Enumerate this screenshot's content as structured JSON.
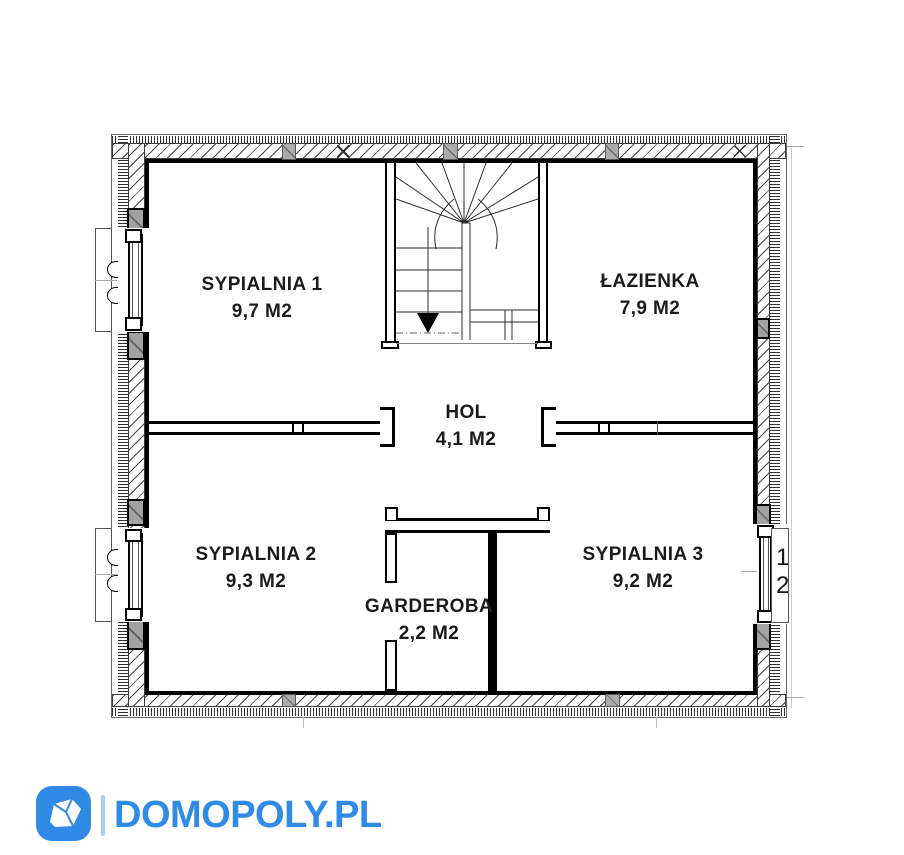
{
  "brand": {
    "name": "DOMOPOLY.PL",
    "color": "#2f8be6",
    "separator_color": "#a6cdf4",
    "icon": "house-gem-icon"
  },
  "floor_plan": {
    "ink_color": "#000000",
    "rooms": [
      {
        "name": "SYPIALNIA 1",
        "area": "9,7 M2"
      },
      {
        "name": "ŁAZIENKA",
        "area": "7,9 M2"
      },
      {
        "name": "HOL",
        "area": "4,1 M2"
      },
      {
        "name": "SYPIALNIA 2",
        "area": "9,3 M2"
      },
      {
        "name": "SYPIALNIA 3",
        "area": "9,2 M2"
      },
      {
        "name": "GARDEROBA",
        "area": "2,2 M2"
      }
    ],
    "stairs": {
      "direction": "down"
    },
    "window_dims": [
      "1",
      "2"
    ]
  }
}
